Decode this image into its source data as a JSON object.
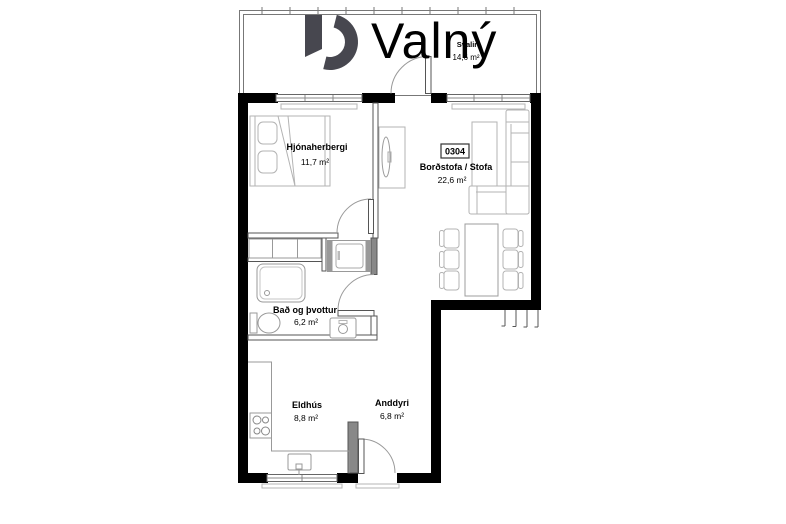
{
  "brand": {
    "name": "Valný"
  },
  "unit": {
    "number": "0304"
  },
  "rooms": {
    "svalir": {
      "name": "Svalir",
      "area": "14,6 m²"
    },
    "hjonaherbergi": {
      "name": "Hjónaherbergi",
      "area": "11,7 m²"
    },
    "bordstofa": {
      "name": "Borðstofa / Stofa",
      "area": "22,6 m²"
    },
    "bad": {
      "name": "Bað og þvottur",
      "area": "6,2 m²"
    },
    "eldhus": {
      "name": "Eldhús",
      "area": "8,8 m²"
    },
    "anddyri": {
      "name": "Anddyri",
      "area": "6,8 m²"
    }
  },
  "colors": {
    "wall": "#000000",
    "logo_mark": "#47474f",
    "logo_text": "#98989e"
  }
}
